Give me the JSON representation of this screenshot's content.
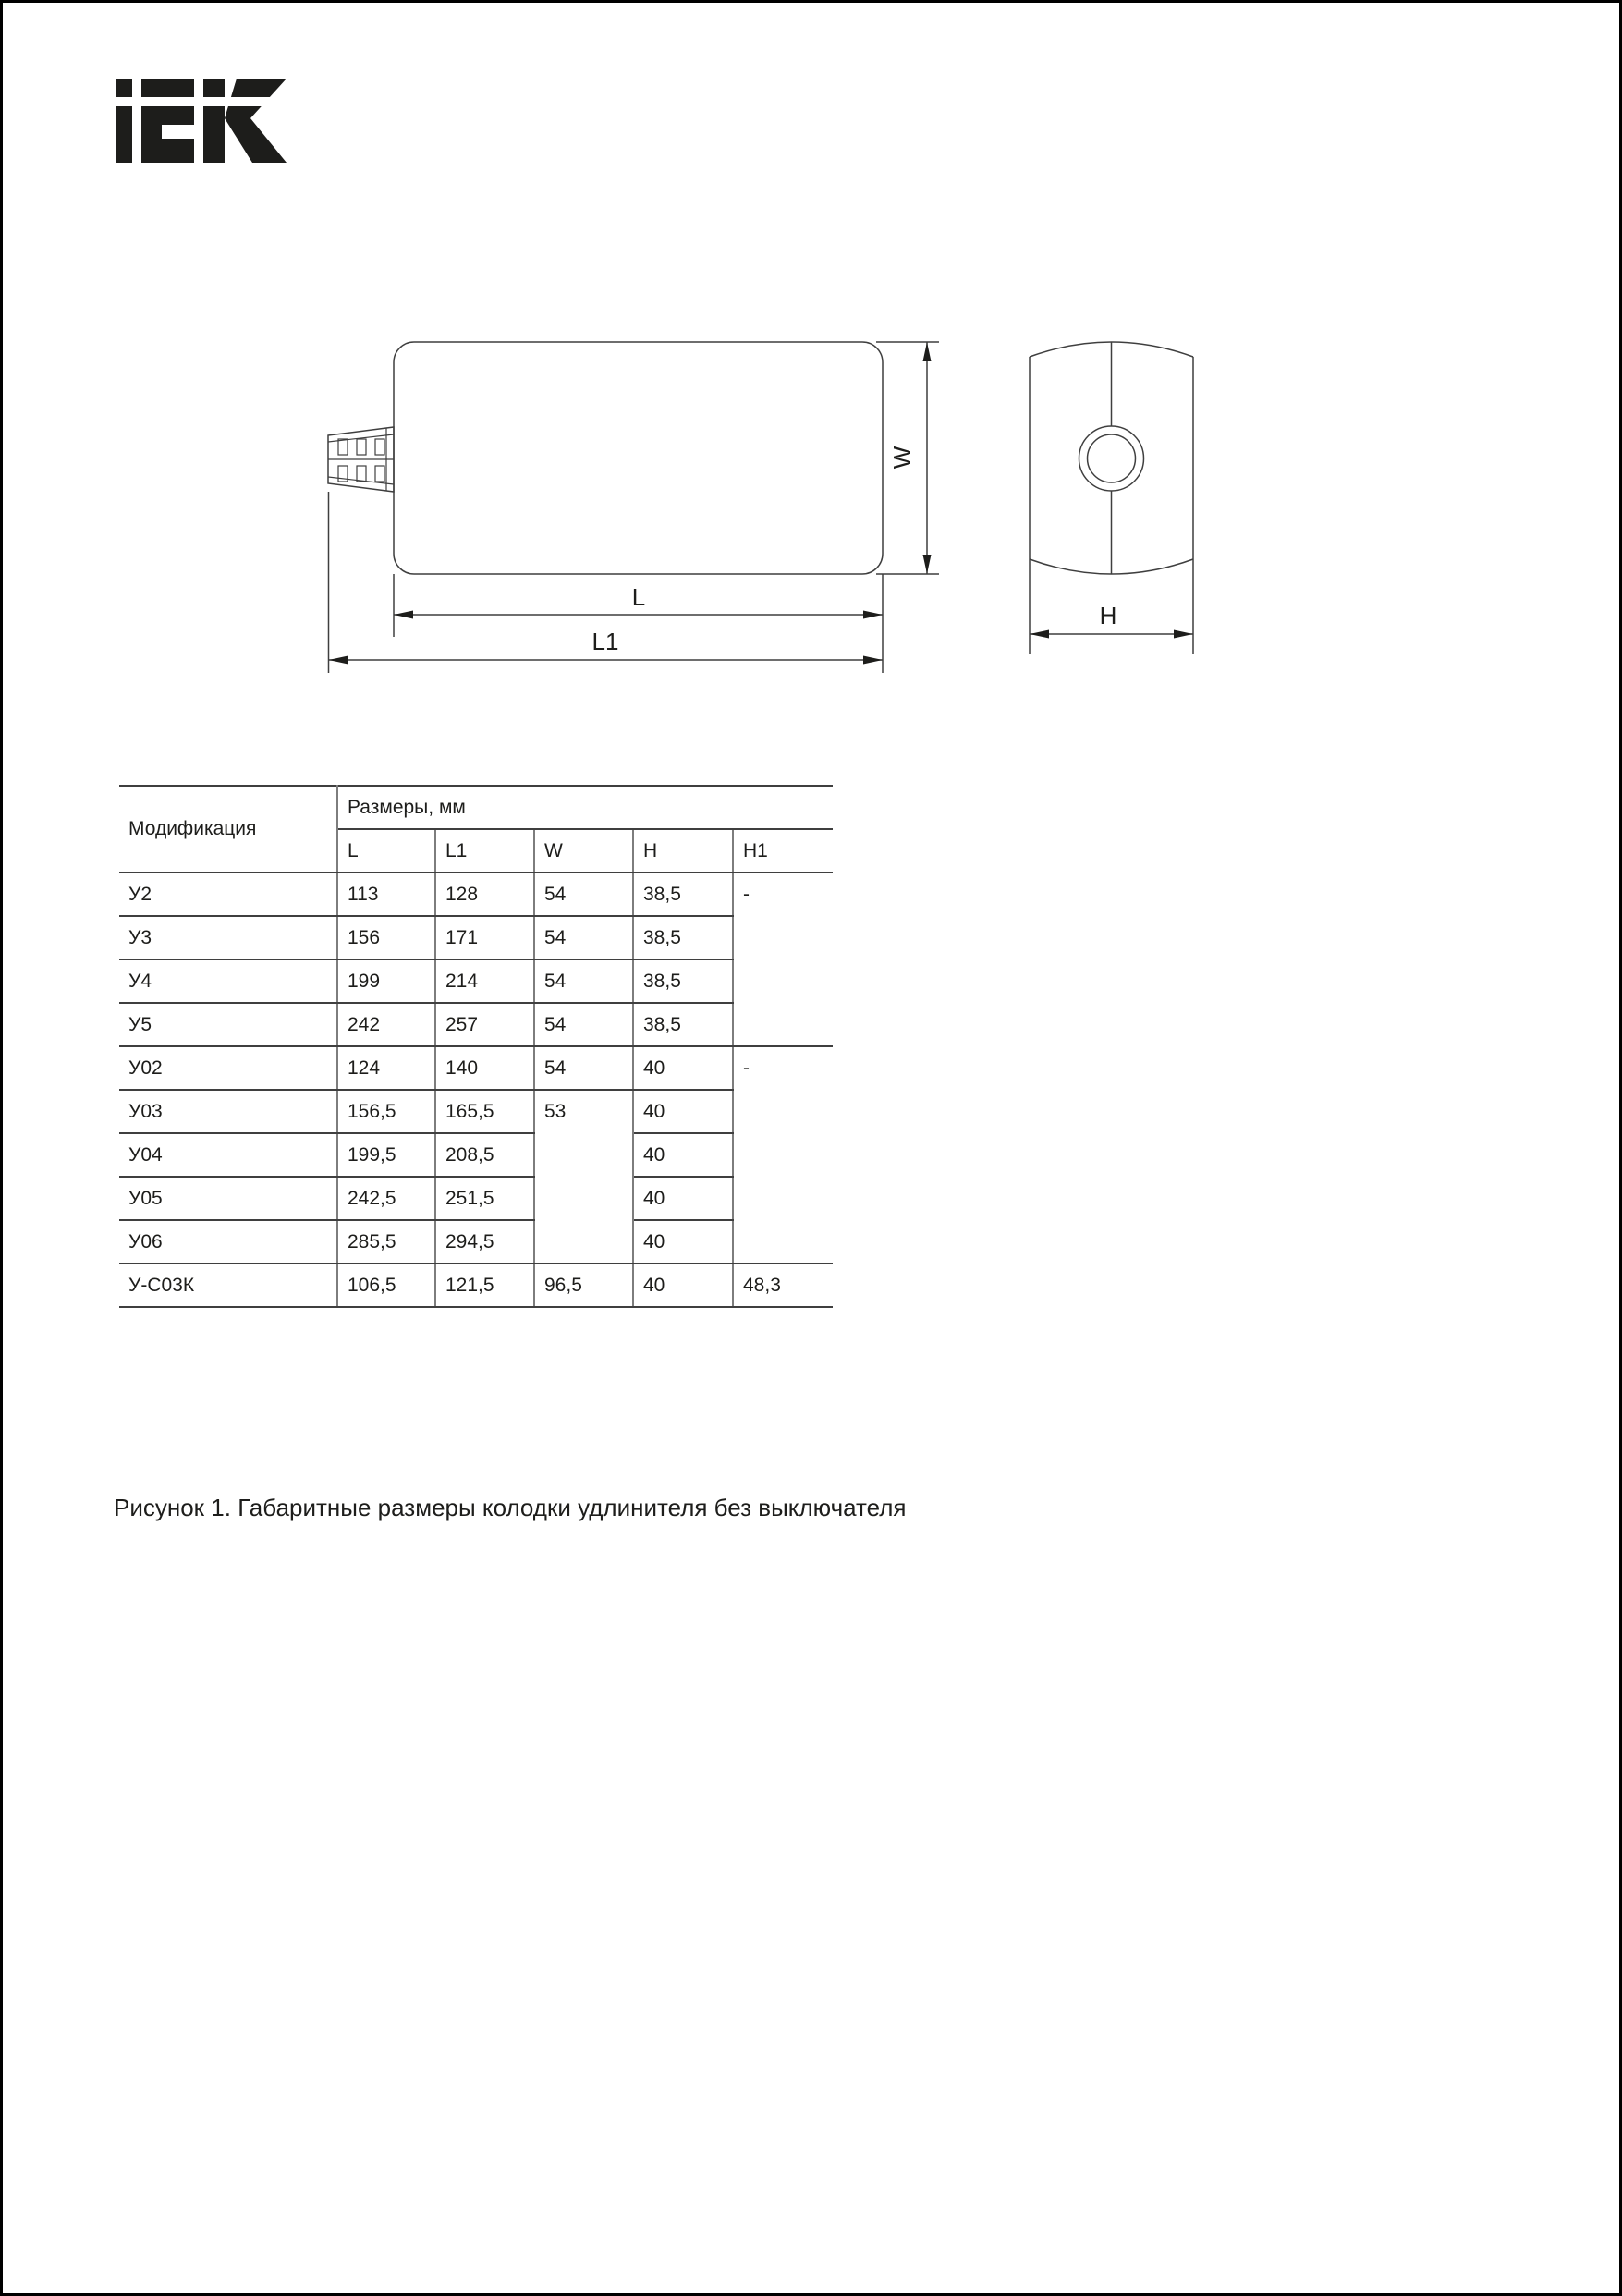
{
  "logo": {
    "text": "IEK"
  },
  "drawing": {
    "labels": {
      "w": "W",
      "l": "L",
      "l1": "L1",
      "h": "H"
    }
  },
  "table": {
    "header": {
      "modification": "Модификация",
      "dimensions": "Размеры, мм",
      "columns": [
        "L",
        "L1",
        "W",
        "H",
        "H1"
      ]
    },
    "rows": [
      {
        "name": "У2",
        "l": "113",
        "l1": "128",
        "w": "54",
        "h": "38,5",
        "h1": "-"
      },
      {
        "name": "У3",
        "l": "156",
        "l1": "171",
        "w": "54",
        "h": "38,5"
      },
      {
        "name": "У4",
        "l": "199",
        "l1": "214",
        "w": "54",
        "h": "38,5"
      },
      {
        "name": "У5",
        "l": "242",
        "l1": "257",
        "w": "54",
        "h": "38,5"
      },
      {
        "name": "У02",
        "l": "124",
        "l1": "140",
        "w": "54",
        "h": "40",
        "h1": "-"
      },
      {
        "name": "У03",
        "l": "156,5",
        "l1": "165,5",
        "w": "53",
        "h": "40"
      },
      {
        "name": "У04",
        "l": "199,5",
        "l1": "208,5",
        "h": "40"
      },
      {
        "name": "У05",
        "l": "242,5",
        "l1": "251,5",
        "h": "40"
      },
      {
        "name": "У06",
        "l": "285,5",
        "l1": "294,5",
        "h": "40"
      },
      {
        "name": "У-С03К",
        "l": "106,5",
        "l1": "121,5",
        "w": "96,5",
        "h": "40",
        "h1": "48,3"
      }
    ]
  },
  "caption": "Рисунок 1. Габаритные размеры колодки удлинителя без выключателя",
  "colors": {
    "ink": "#1d1d1b",
    "drawing_line": "#3f3f3f",
    "table_divider": "#7d7d7d",
    "frame": "#000000",
    "background": "#ffffff"
  }
}
